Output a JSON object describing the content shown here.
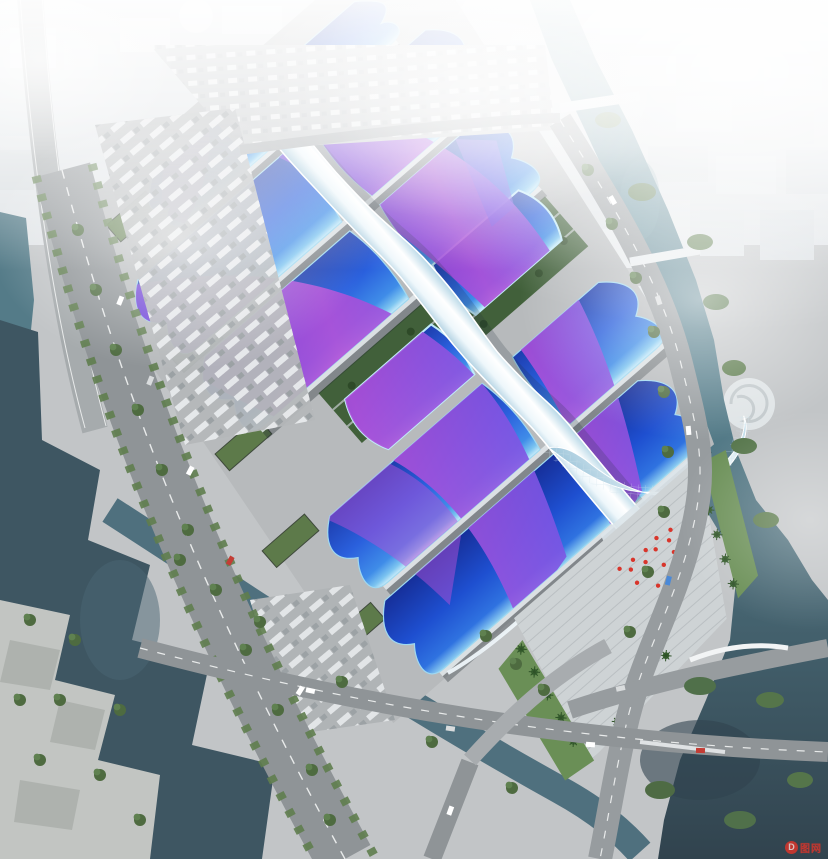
{
  "scene": {
    "type": "aerial-architectural-rendering",
    "landmarks": {
      "main_complex": "exhibition-center-halls",
      "spine": "central-serpentine-canopy",
      "court": "central-garden-court",
      "entrance": "south-entrance-plaza",
      "waterways": [
        "left-lake",
        "right-river",
        "diagonal-canal"
      ],
      "roads": [
        "west-boulevard",
        "east-arc-road",
        "south-cross-avenue"
      ],
      "parking": [
        "north-parking-lot",
        "west-freight-yard",
        "bus-parking"
      ],
      "city": "hazy-city-skyline"
    }
  },
  "colors": {
    "ground": "#c2c5c7",
    "slab": "#b7babc",
    "plaza": "#ced3d5",
    "road": "#8f9497",
    "road_light": "#a5aaad",
    "water_dark": "#3e5662",
    "water_teal": "#547b88",
    "roof_deep": "#1d3dae",
    "roof_blue": "#2b63e0",
    "roof_cyan": "#9fd8f0",
    "ribbon_purple": "#8a46d6",
    "ribbon_magenta": "#b24fd8",
    "spine_white": "#eef6fa",
    "tree": "#55754a",
    "lawn": "#6a8f56",
    "accent_red": "#d8352b",
    "city_block": "#e3e7ea"
  },
  "watermark": {
    "logo_letter": "D",
    "text": "图网"
  }
}
